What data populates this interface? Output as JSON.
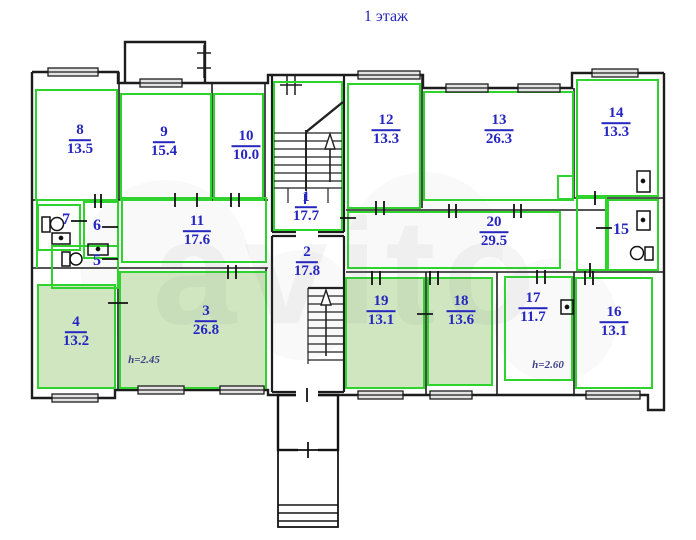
{
  "title": "1 этаж",
  "watermark": "avito",
  "colors": {
    "plan_green": "#2ed32e",
    "highlight_fill": "#cfe6c0",
    "label_blue": "#2626c0",
    "wall_black": "#1d1d1d"
  },
  "rooms": {
    "r1": {
      "number": "1",
      "area": "17.7"
    },
    "r2": {
      "number": "2",
      "area": "17.8"
    },
    "r3": {
      "number": "3",
      "area": "26.8"
    },
    "r4": {
      "number": "4",
      "area": "13.2"
    },
    "r5": {
      "number": "5"
    },
    "r6": {
      "number": "6"
    },
    "r7": {
      "number": "7"
    },
    "r8": {
      "number": "8",
      "area": "13.5"
    },
    "r9": {
      "number": "9",
      "area": "15.4"
    },
    "r10": {
      "number": "10",
      "area": "10.0"
    },
    "r11": {
      "number": "11",
      "area": "17.6"
    },
    "r12": {
      "number": "12",
      "area": "13.3"
    },
    "r13": {
      "number": "13",
      "area": "26.3"
    },
    "r14": {
      "number": "14",
      "area": "13.3"
    },
    "r15": {
      "number": "15"
    },
    "r16": {
      "number": "16",
      "area": "13.1"
    },
    "r17": {
      "number": "17",
      "area": "11.7"
    },
    "r18": {
      "number": "18",
      "area": "13.6"
    },
    "r19": {
      "number": "19",
      "area": "13.1"
    },
    "r20": {
      "number": "20",
      "area": "29.5"
    }
  },
  "notes": {
    "room3_height": "h=2.45",
    "room17_height": "h=2.60"
  }
}
